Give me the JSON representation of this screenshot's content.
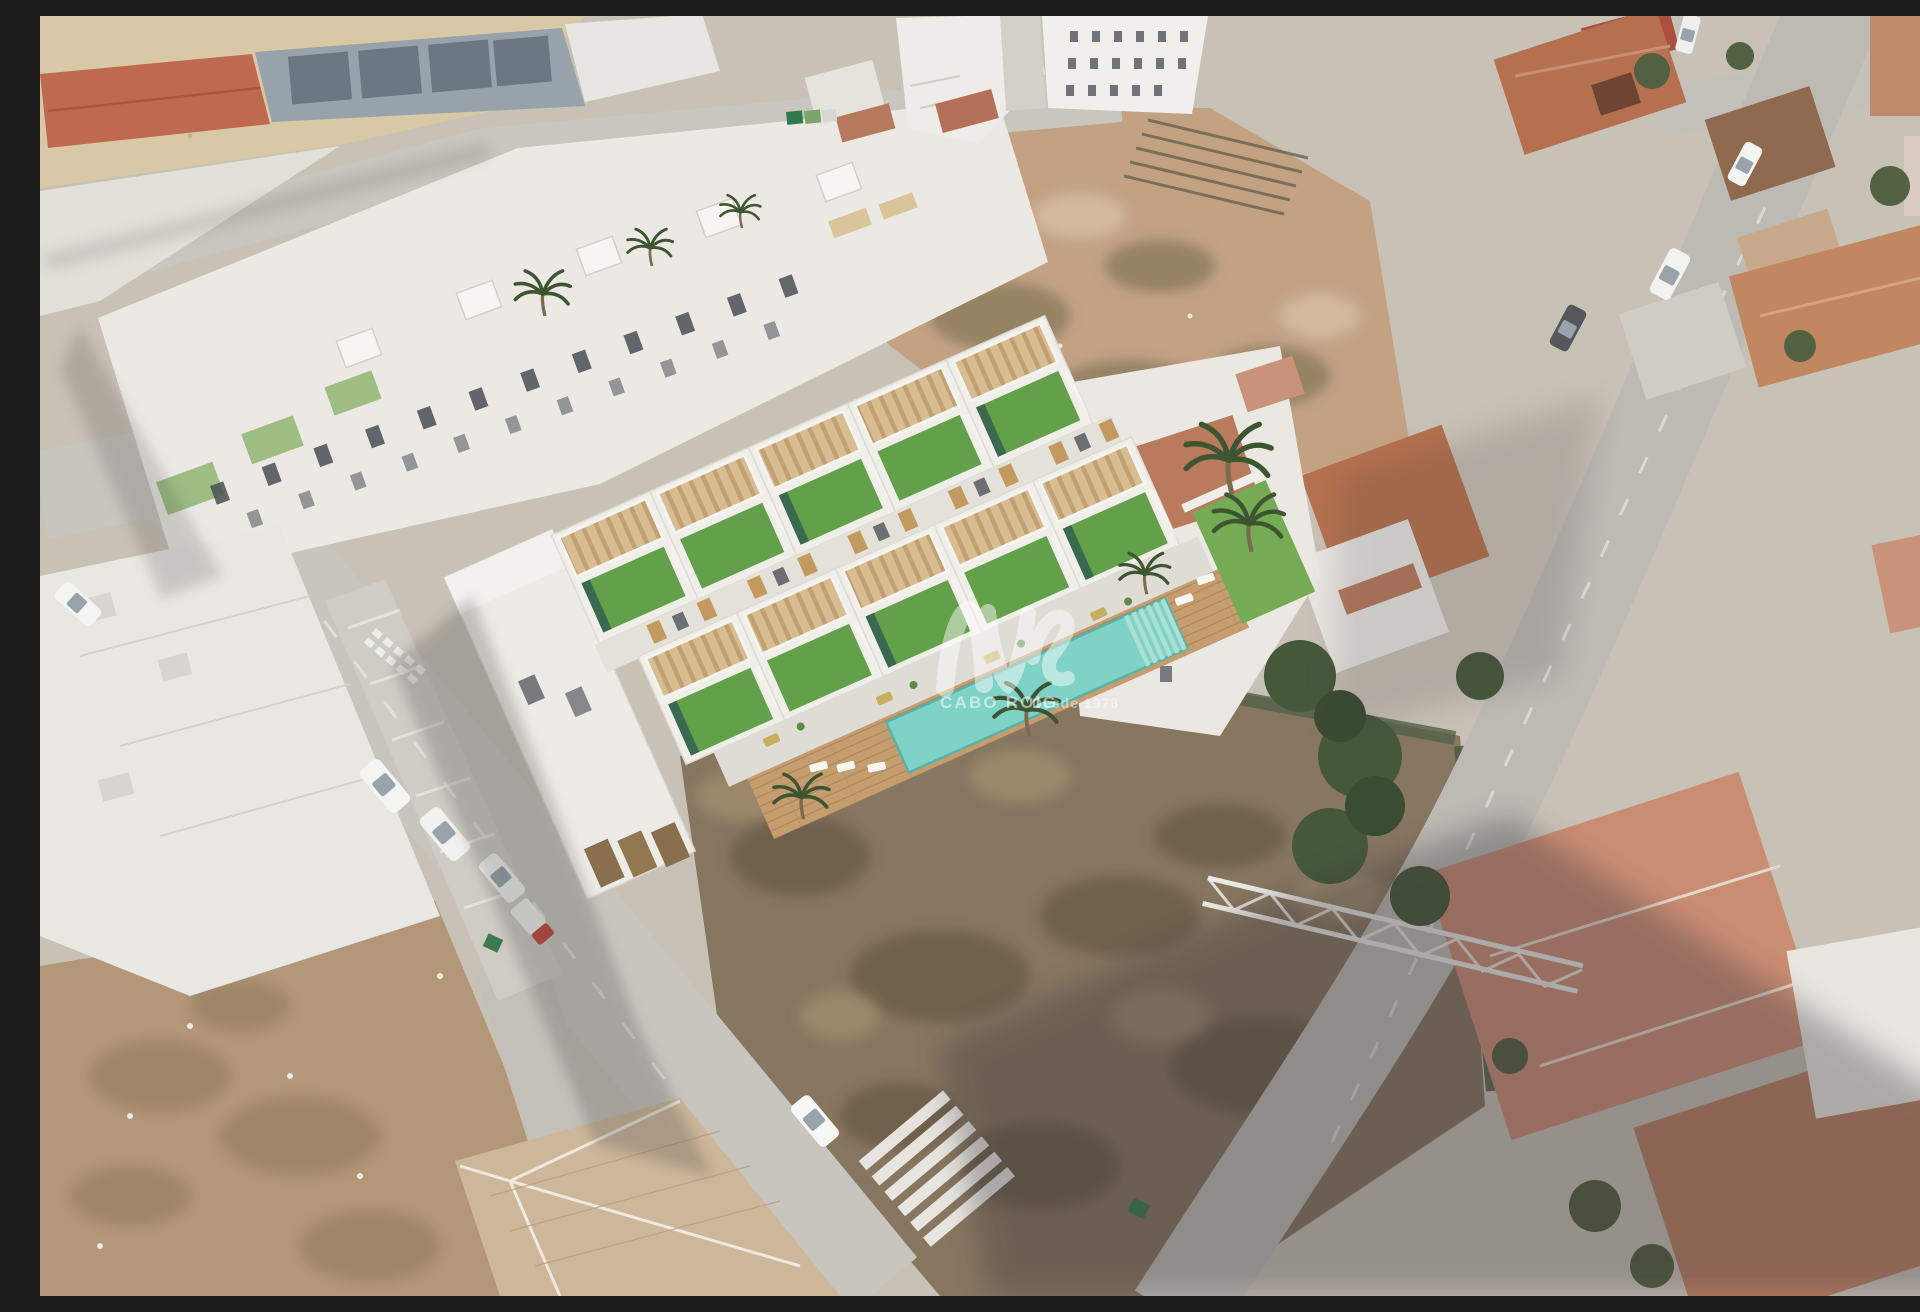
{
  "image": {
    "kind": "aerial-3d-render-composite",
    "subject": "New-build Mediterranean townhouse development with roof solariums, green roofs and communal pool, composited onto an aerial photograph of an existing town"
  },
  "watermark": {
    "logo_icon": "cabo-roig-monogram",
    "brand": "CABO ROIG",
    "tagline": "Desde 1978",
    "color": "#ffffff"
  },
  "palette": {
    "sand": "#d9c8a5",
    "street": "#c8c5bf",
    "street_right": "#bdbab4",
    "dirt_top": "#c3a284",
    "dirt_bottom": "#877660",
    "dirt_left": "#b29878",
    "render_white": "#f0eee9",
    "green_roof": "#63a04a",
    "lawn": "#76ab55",
    "pergola_wood": "#d8bd92",
    "deck_wood": "#c59d6f",
    "pool_water": "#7fd2c6",
    "pool_steps": "#b0e3d7",
    "terracotta": "#b5714f",
    "terracotta_pale": "#c98d74",
    "tree_green": "#46583a",
    "shadow": "#4a4845"
  },
  "scene": {
    "new_development": {
      "townhouse_rows": 2,
      "units_per_row": 5,
      "features": [
        "roof solariums with slatted pergolas",
        "artificial-grass green roofs",
        "external white staircases",
        "communal swimming pool with entry steps",
        "timber sun deck",
        "sun loungers",
        "palm trees",
        "garage doors",
        "timber-slat shutters"
      ]
    },
    "surroundings": [
      "existing white apartment block with roof terraces",
      "industrial building with red roof",
      "solar-panel roof",
      "white gabled houses",
      "vacant dirt plots",
      "fallen steel truss",
      "terracotta-roofed town houses",
      "tree clusters",
      "parked cars and vans",
      "zebra crossing",
      "road markings",
      "waste containers"
    ]
  }
}
